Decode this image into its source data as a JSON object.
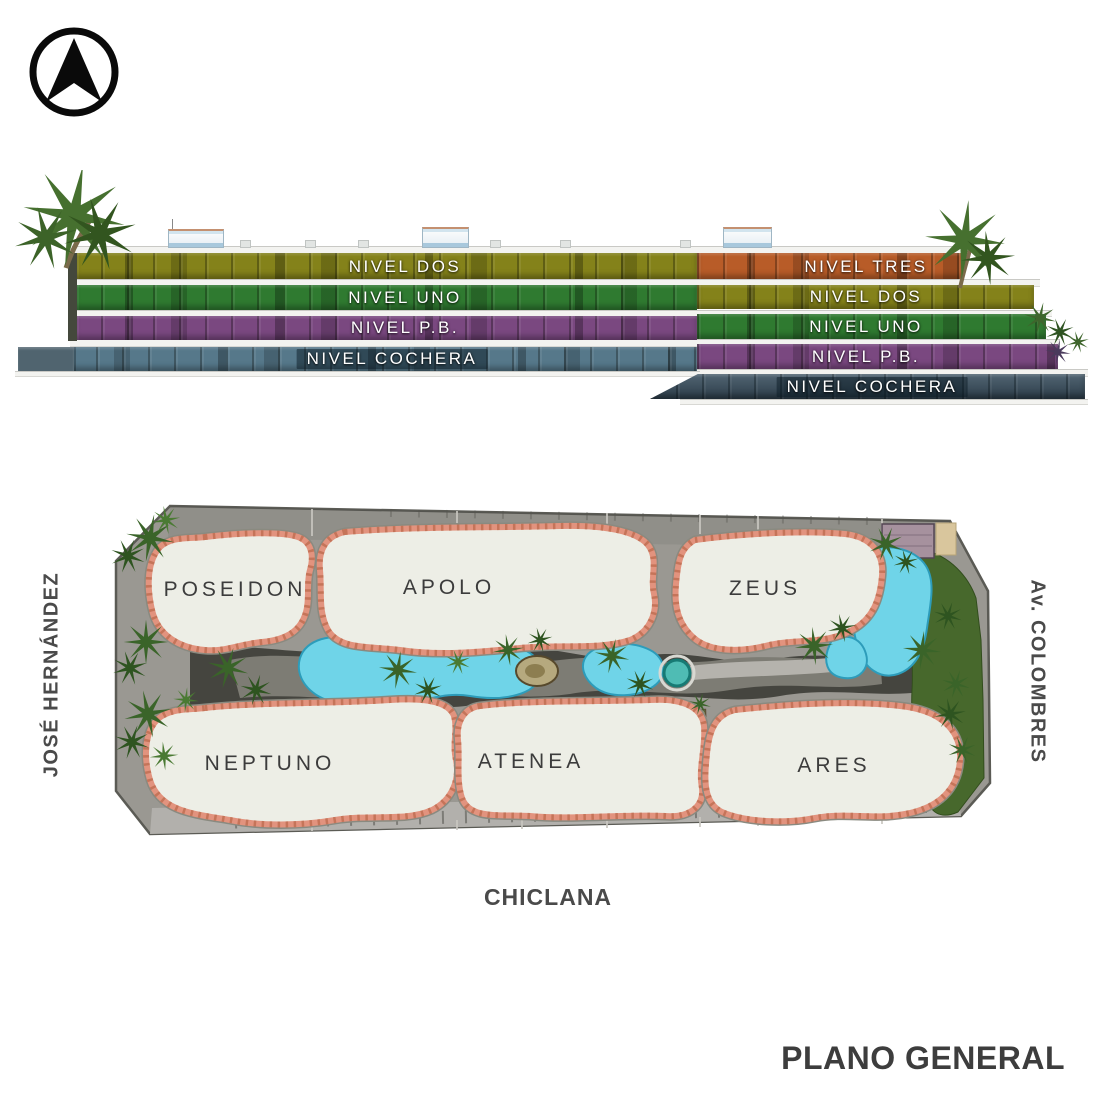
{
  "compass": {
    "icon": "north-arrow-icon"
  },
  "elevation": {
    "left_building": {
      "levels": [
        {
          "label": "NIVEL DOS",
          "color": "#84821a"
        },
        {
          "label": "NIVEL UNO",
          "color": "#2f7a30"
        },
        {
          "label": "NIVEL P.B.",
          "color": "#7a4880"
        },
        {
          "label": "NIVEL COCHERA",
          "color": "#56788a"
        }
      ]
    },
    "right_building": {
      "levels": [
        {
          "label": "NIVEL TRES",
          "color": "#b85c28"
        },
        {
          "label": "NIVEL DOS",
          "color": "#84821a"
        },
        {
          "label": "NIVEL UNO",
          "color": "#2f7a30"
        },
        {
          "label": "NIVEL P.B.",
          "color": "#7a4880"
        },
        {
          "label": "NIVEL COCHERA",
          "color": "#3a5060"
        }
      ]
    }
  },
  "site_plan": {
    "buildings": [
      {
        "name": "POSEIDON"
      },
      {
        "name": "APOLO"
      },
      {
        "name": "ZEUS"
      },
      {
        "name": "NEPTUNO"
      },
      {
        "name": "ATENEA"
      },
      {
        "name": "ARES"
      }
    ],
    "streets": {
      "left": "JOSÉ HERNÁNDEZ",
      "right": "Av. COLOMBRES",
      "bottom": "CHICLANA"
    },
    "features": {
      "pool_color": "#6fd4e8",
      "lawn_color": "#47682c",
      "tile_border_color": "#e2937e"
    }
  },
  "footer": {
    "title": "PLANO GENERAL"
  }
}
